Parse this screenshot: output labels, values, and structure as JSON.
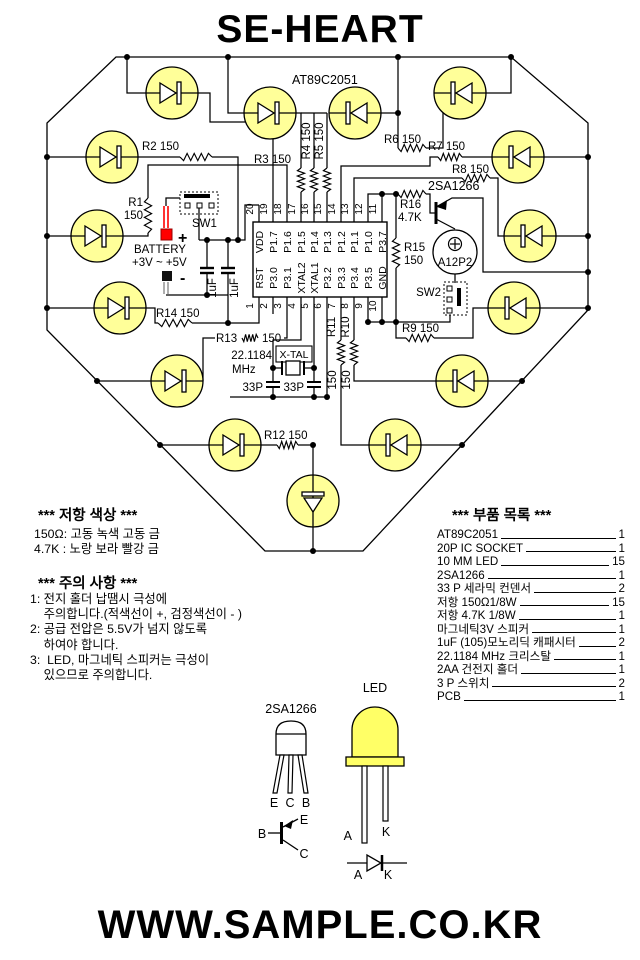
{
  "title": "SE-HEART",
  "footer": "WWW.SAMPLE.CO.KR",
  "colors": {
    "led_fill": "#ffff99",
    "led_dome": "#ffff66",
    "battery_positive": "#ff0000"
  },
  "schematic": {
    "mcu": "AT89C2051",
    "ic": {
      "top": [
        {
          "n": "20",
          "p": "VDD"
        },
        {
          "n": "19",
          "p": "P1.7"
        },
        {
          "n": "18",
          "p": "P1.6"
        },
        {
          "n": "17",
          "p": "P1.5"
        },
        {
          "n": "16",
          "p": "P1.4"
        },
        {
          "n": "15",
          "p": "P1.3"
        },
        {
          "n": "14",
          "p": "P1.2"
        },
        {
          "n": "13",
          "p": "P1.1"
        },
        {
          "n": "12",
          "p": "P1.0"
        },
        {
          "n": "11",
          "p": "P3.7"
        }
      ],
      "bottom": [
        {
          "n": "1",
          "p": "RST"
        },
        {
          "n": "2",
          "p": "P3.0"
        },
        {
          "n": "3",
          "p": "P3.1"
        },
        {
          "n": "4",
          "p": "XTAL2"
        },
        {
          "n": "5",
          "p": "XTAL1"
        },
        {
          "n": "6",
          "p": "P3.2"
        },
        {
          "n": "7",
          "p": "P3.3"
        },
        {
          "n": "8",
          "p": "P3.4"
        },
        {
          "n": "9",
          "p": "P3.5"
        },
        {
          "n": "10",
          "p": "GND"
        }
      ]
    },
    "resistors": {
      "r1": {
        "a": "R1",
        "b": "150"
      },
      "r2": "R2  150",
      "r3": "R3 150",
      "r4": "R4 150",
      "r5": "R5 150",
      "r6": "R6 150",
      "r7": "R7  150",
      "r8": "R8 150",
      "r9": "R9  150",
      "r10": {
        "a": "R10",
        "b": "150"
      },
      "r11": {
        "a": "R11",
        "b": "150"
      },
      "r12": "R12 150",
      "r13": {
        "a": "R13",
        "b": "150"
      },
      "r14": "R14 150",
      "r15": {
        "a": "R15",
        "b": "150"
      },
      "r16": {
        "a": "R16",
        "b": "4.7K"
      }
    },
    "battery": {
      "label": "BATTERY",
      "range": "+3V ~ +5V",
      "plus": "+",
      "minus": "-"
    },
    "switches": {
      "sw1": "SW1",
      "sw2": "SW2"
    },
    "caps": {
      "c1": "1uF",
      "c2": "1uF",
      "c3": "33P",
      "c4": "33P"
    },
    "xtal": {
      "freq": "22.1184",
      "unit": "MHz",
      "name": "X-TAL"
    },
    "transistor": "2SA1266",
    "speaker": "A12P2"
  },
  "notes_resistor": {
    "title": "*** 저항 색상 ***",
    "lines": [
      "150Ω: 고동 녹색 고동 금",
      "4.7K : 노랑 보라 빨강 금"
    ]
  },
  "notes_caution": {
    "title": "*** 주의 사항 ***",
    "lines": [
      "1: 전지 홀더 납땜시 극성에",
      "    주의합니다.(적색선이 +, 검정색선이 - )",
      "2: 공급 전압은 5.5V가 넘지 않도록",
      "    하여야 합니다.",
      "3:  LED, 마그네틱 스피커는 극성이",
      "    있으므로 주의합니다."
    ]
  },
  "parts": {
    "title": "*** 부품 목록 ***",
    "items": [
      {
        "name": "AT89C2051",
        "qty": "1"
      },
      {
        "name": "20P IC SOCKET",
        "qty": "1"
      },
      {
        "name": "10 MM LED",
        "qty": "15"
      },
      {
        "name": "2SA1266",
        "qty": "1"
      },
      {
        "name": "33 P 세라믹 컨덴서",
        "qty": "2"
      },
      {
        "name": "저항 150Ω1/8W",
        "qty": "15"
      },
      {
        "name": "저항 4.7K 1/8W",
        "qty": "1"
      },
      {
        "name": "마그네틱3V 스피커",
        "qty": "1"
      },
      {
        "name": "1uF (105)모노리딕 캐패시터",
        "qty": "2"
      },
      {
        "name": "22.1184 MHz 크리스탈",
        "qty": "1"
      },
      {
        "name": "2AA 건전지 홀더",
        "qty": "1"
      },
      {
        "name": "3 P 스위치",
        "qty": "2"
      },
      {
        "name": "PCB",
        "qty": "1"
      }
    ]
  },
  "drawings": {
    "transistor": {
      "label": "2SA1266",
      "e": "E",
      "c": "C",
      "b": "B"
    },
    "led": {
      "label": "LED",
      "a": "A",
      "k": "K"
    },
    "diode": {
      "a": "A",
      "k": "K"
    }
  }
}
